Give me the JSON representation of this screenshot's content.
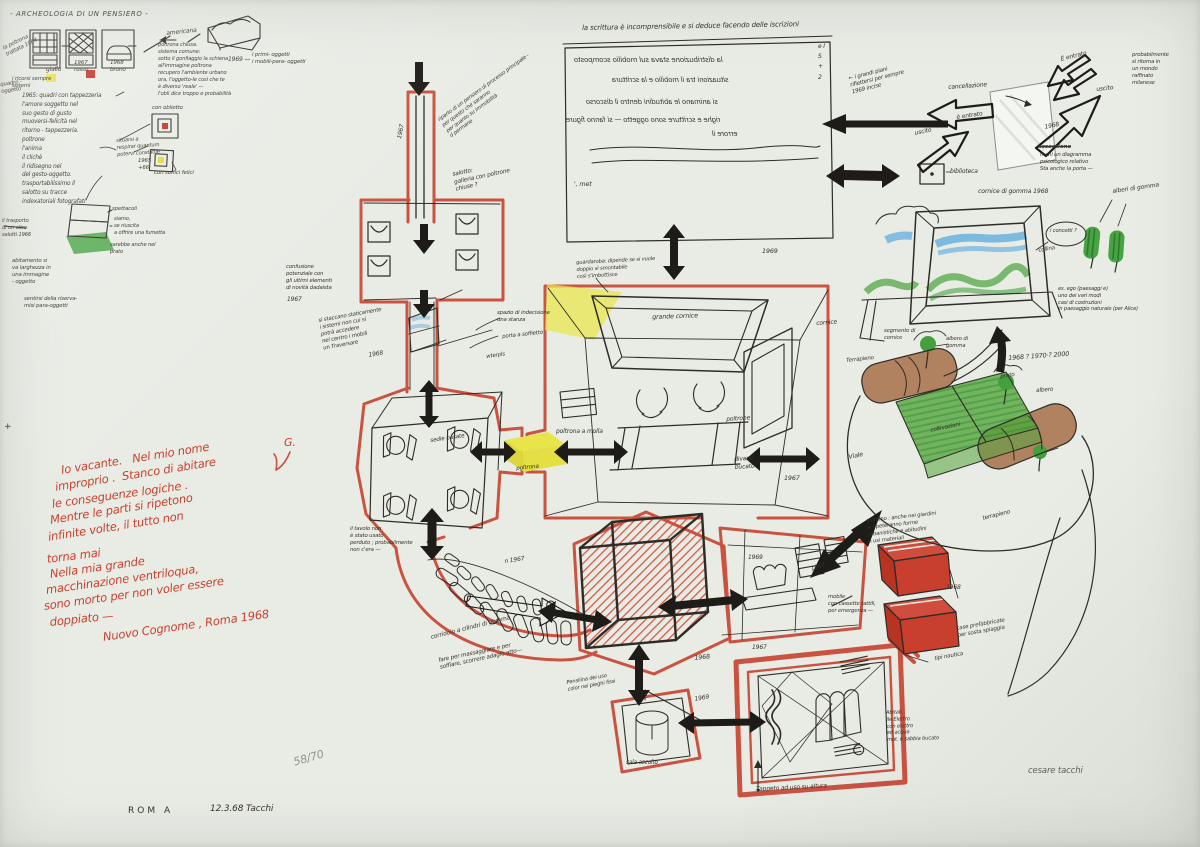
{
  "artwork": {
    "title_inscription": "- ARCHEOLOGIA DI UN PENSIERO -",
    "edition": "58/70",
    "plate": "ROM  A",
    "date_inscription": "12.3.68    Tacchi",
    "pencil_signature": "cesare tacchi"
  },
  "palette": {
    "paper": "#e9ece5",
    "ink": "#2e2c27",
    "red": "#c84634",
    "yellow": "#e9e64a",
    "green": "#4aa33d",
    "blue": "#58a9de",
    "brown": "#a67048"
  },
  "red_poem": {
    "mark": "G.",
    "lines": [
      "Io vacante.   Nel mio nome",
      "improprio .  Stanco di abitare",
      "le conseguenze logiche .",
      "Mentre le parti si ripetono",
      "infinite volte, il tutto non",
      "torna mai",
      "Nella mia grande",
      "macchinazione ventriloqua,",
      "sono morto per non voler essere",
      "doppiato —"
    ],
    "signature": "Nuovo Cognome , Roma 1968"
  },
  "mirror_box": {
    "caption": "la scrittura è incomprensibile e si deduce facendo delle iscrizioni",
    "lines": [
      "la distribuzione stava sul mobilio scomposto",
      "situazioni tra il mobilio e la scrittura",
      "si animano le abitudini dentro il discorso",
      "righe e scritture sono oggetto — si fanno figure",
      "errore il"
    ],
    "note": "', met",
    "side": "e I\nS\n+\n2",
    "year": "1969"
  },
  "ann": {
    "amer": "americana",
    "chair1": "giallo",
    "chair2": "1967\nrosso",
    "chair3": "1968\nbruno",
    "edge1": "la poltrona\ntrattata 1964",
    "edge2": "quadro -\noggetto",
    "edge3": "i ricorsi sempre\nsistemi",
    "sofa_note": "poltrona chiusa.\nsistema comune:\nsotto il gonfiaggio la schiena\nall'immagine poltrona\nrecupero l'ambiente urbano\nora, l'oggetto-le così che te\nè diverso 'reale' —\nl'oblì dice troppo e probabilità",
    "sofa_year": "1969 —",
    "sofa_right": "i primi- oggetti\ni mobili-para- oggetti",
    "col65": "1965:  quadri con tappezzeria\nl'amore soggetto nel\nsuo gesto di gusto\nmuoversi-felicità nel\nritorno - tappezzeria.\npoltrone\nl'anima\nil clichè\nil ridisegno nel\ndel gesto-oggetto.\ntrasportabilissimo il\nsalotto su tracce\nindexatoriali fotografati",
    "sq1": "con oblietto",
    "sq_mid": "situarsi a\nrespirar quantum\npotervi constatile",
    "sq_year": "1965\n+66",
    "sq2": "con soffici felici",
    "lap1": "spettacoli",
    "lap2": "siamo,\nse riuscita\na offrire una fumetta",
    "lap3": "sarebbe anche nel\nprato",
    "lap_left": "il trasporto\ndi un altro\nsalotti 1966",
    "abit": "abitamento si\nva larghezza in\nuna immagine\n- oggetto",
    "sent": "sentirsi della riserva-\nmisi para-oggetti",
    "conf": "confusione\npotenziale con\ngli ultimi elementi\ndi novità dadaista",
    "conf_year": "1967",
    "stacc": "si staccano staticamente\ni sistemi non cui si\npotrà accedere\nnel centro i mobili\nun Traversare",
    "stacc_year": "1968",
    "salotto": "salotto:\ngalleria con poltrone\nchiuse ?",
    "corr_year": "1967",
    "ripart": "riparto di un pensiero di processo principale -\nper questo che saranno\nper quanto su immobilità\nd permane",
    "spazio": "spazio di indecisione\nuna stanza",
    "porta": "porta a soffietto",
    "wtp": "wterpls",
    "guard": "guardaroba: dipende se si vuole\ndoppio sì smontabile\ncosì s'imbottisce",
    "grande": "grande cornice",
    "corniceR": "cornice",
    "molla": "poltrona a molla",
    "poltrone": "poltrone",
    "divano": "divano\nbucato",
    "roomC_year": "1967",
    "sedie": "sedie basate",
    "gialla_p": "poltrona",
    "tavolo": "il tavolo non\nè stato usato\nperduto ; probabilmente\nnon c'era —",
    "corridoio": "corridoio a cilindri di gomma",
    "fare": "fare per massaggiare e per\nsoffiare, scorrere adagio atto—",
    "corrD_year": "n 1967",
    "cube_year": "1968",
    "roomF_y1": "1969",
    "roomF_y2": "1967",
    "pens": "Pensilina dei uso\ncolor nei pieghi fissi",
    "sala": "sala ascolto",
    "roomG_year": "1969",
    "picH_year": "1967",
    "tappeto": "Tappeto ad uso su altura",
    "abitH": "Abitab.\nile Elettro\ncon elettro\ned acqua\nmat. e sabbia bucato",
    "divani2": "mobile\ncon cassette tattili,\nper emergenza —",
    "case": "case prefabbricate\nper sosta spiaggia",
    "tipo": "tipi nautica",
    "boxes_year": "1968",
    "giard": "giardino : anche nei giardini\nsi ripeteranno forme\nurbanistiche e abitudini\ne usi materiali",
    "grandi": "← i grandi piani\nriflettersi per sempre\n1969 incise",
    "cancell": "cancellazione",
    "entr2": "è entrato",
    "usc2": "uscito",
    "biblio": "biblioteca",
    "entr1": "È entrato",
    "usc1": "uscito",
    "tr_year": "1968",
    "crossed": "ossessione",
    "diagr": "meni un diagramma\npsicologico relativo\nSta anche la porta —",
    "probab": "probabilmente\nsi ritorna in\nun mondo\nraffinato\nmilanese",
    "cornice_g": "cornice di gomma     1968",
    "alberi_g": "alberi di gomma",
    "concept": "i concetti ?",
    "collina": "collina",
    "eco": "es. ego (paesaggi e)\nuno dei vari modi\ncasi di costruzioni\nin paesaggio naturale (per Alice)",
    "segmento": "segmento di\ncornice",
    "years_q": "1968   ?   1970·?   2000",
    "terr1": "Terrapieno",
    "prato": "prato",
    "albero": "albero",
    "alb_g2": "albero di\ngomma",
    "coltiv": "coltivazioni",
    "viale": "Viale",
    "terr2": "terrapieno",
    "plus": "+"
  }
}
